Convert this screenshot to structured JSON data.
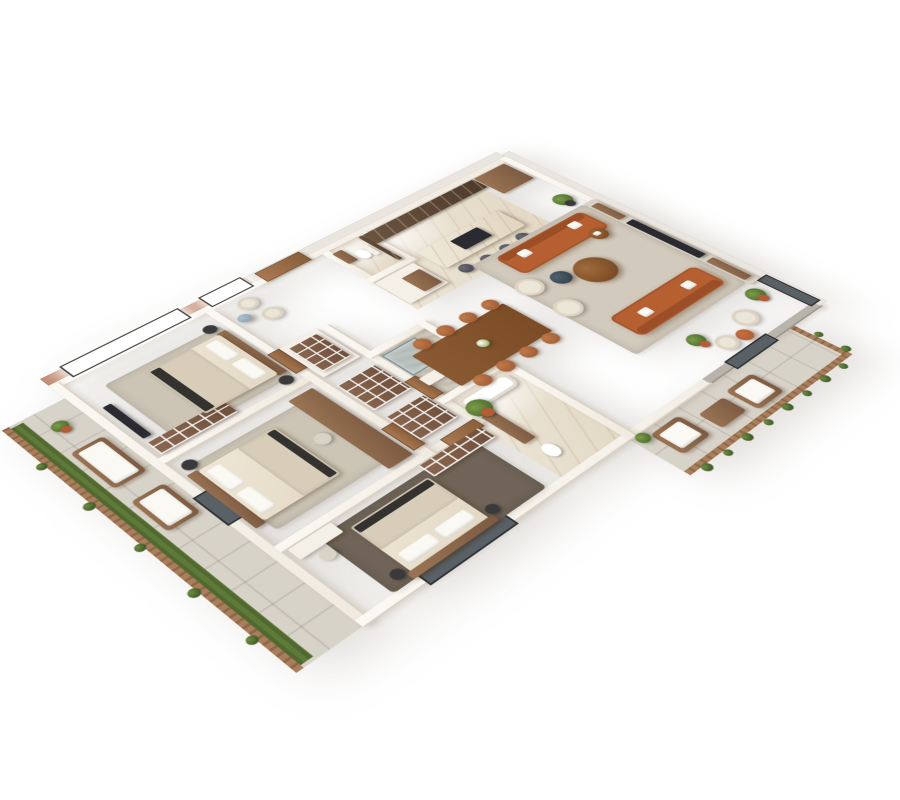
{
  "meta": {
    "kind": "3d-floor-plan-render",
    "projection": "isometric-cutaway",
    "background": "#ffffff",
    "visible_text": "none"
  },
  "palette": {
    "wall": "#f0eadf",
    "wallShadow": "#d9d2c5",
    "exteriorSalmon": "#c28e74",
    "exteriorLight": "#eae6df",
    "concrete": "#b9b4ab",
    "floorWood1": "#97755c",
    "floorWood2": "#85654e",
    "floorMarble1": "#efe8da",
    "floorMarble2": "#e2d8c4",
    "floorTile": "#d8d3c9",
    "floorStone": "#cfc8bb",
    "grass": "#5e7a38",
    "bushGreen": "#3f5c28",
    "fenceWood1": "#a87e5c",
    "fenceWood2": "#8f6848",
    "rugLiving": "#d2cabc",
    "rugBedroom": "#ccc5b6",
    "rugDark": "#6f6457",
    "sofaCognac": "#b65f31",
    "sofaCognacDark": "#9c4e26",
    "chairCognac": "#a5613a",
    "armWhite": "#ece6d8",
    "woodFurn": "#7c5a41",
    "woodFurnLight": "#9a7454",
    "tableWood": "#7c4c26",
    "darkUnit": "#2b2a30",
    "stoolGrey": "#4b4a54",
    "counterDark": "#4e3b2c",
    "mattress": "#e2d8c4",
    "blanket": "#d7cdb9",
    "throwDark": "#34322f",
    "potTerracotta": "#b35c35",
    "plantGreen": "#50702e",
    "marbleBlueTable": "#8fa3b5"
  },
  "scene": {
    "rooms": [
      {
        "id": "balcony-left",
        "name": "side balcony",
        "floor": "tile",
        "furniture": [
          "wood-slat-fence",
          "planter-grass-strip",
          "cushioned-bench",
          "cushioned-bench",
          "potted-plant",
          "shrubs"
        ]
      },
      {
        "id": "bedroom-1",
        "name": "bedroom (top-left)",
        "floor": "herringbone wood",
        "furniture": [
          "double-bed",
          "wood-headboard",
          "pillows",
          "nightstand",
          "nightstand",
          "area-rug",
          "wardrobe-shelves",
          "media-console",
          "window"
        ]
      },
      {
        "id": "bedroom-2",
        "name": "bedroom (middle-left)",
        "floor": "herringbone wood",
        "furniture": [
          "double-bed",
          "slat-headboard-wall",
          "pillows",
          "nightstand",
          "long-desk-console",
          "desk-chair",
          "balcony-door"
        ]
      },
      {
        "id": "master-bedroom",
        "name": "master bedroom (bottom)",
        "floor": "herringbone wood",
        "furniture": [
          "double-bed",
          "dark-area-rug",
          "desk",
          "desk-chair",
          "wardrobe-shelves",
          "nightstand",
          "window"
        ]
      },
      {
        "id": "hallway",
        "name": "hallway / corridor",
        "floor": "herringbone wood",
        "furniture": [
          "lounge-chair",
          "lounge-chair",
          "round-marble-side-table",
          "storage-shelving",
          "storage-shelving",
          "storage-shelving"
        ]
      },
      {
        "id": "entry",
        "name": "entry",
        "floor": "herringbone wood",
        "furniture": [
          "entry-door"
        ]
      },
      {
        "id": "guest-wc",
        "name": "guest WC",
        "floor": "marble",
        "furniture": [
          "toilet",
          "vanity",
          "dark-marble-wall"
        ]
      },
      {
        "id": "shower-bath",
        "name": "shower bathroom",
        "floor": "stone",
        "furniture": [
          "glass-shower",
          "vanity"
        ]
      },
      {
        "id": "master-bath",
        "name": "master bathroom",
        "floor": "marble",
        "furniture": [
          "bathtub",
          "vanity",
          "toilet"
        ]
      },
      {
        "id": "kitchen",
        "name": "kitchen",
        "floor": "marble",
        "furniture": [
          "dark-marble-counter-run",
          "kitchen-island-with-cooktop",
          "bar-stool",
          "bar-stool",
          "bar-stool",
          "bar-stool",
          "white-prep-table",
          "tall-wood-cabinet"
        ]
      },
      {
        "id": "dining",
        "name": "dining area",
        "floor": "herringbone wood",
        "furniture": [
          "rect-dining-table",
          "dining-chair-x8",
          "flower-centerpiece",
          "potted-palm"
        ]
      },
      {
        "id": "living",
        "name": "living room",
        "floor": "herringbone wood",
        "furniture": [
          "area-rug",
          "cognac-leather-sofa",
          "cognac-leather-sofa",
          "round-coffee-table",
          "small-dark-coffee-table",
          "round-side-table",
          "white-armchair",
          "white-armchair",
          "tv-media-wall",
          "potted-plant",
          "potted-plant",
          "reading-nook-armchair",
          "orange-side-table",
          "concrete-half-wall"
        ]
      },
      {
        "id": "terrace",
        "name": "bottom terrace",
        "floor": "tile",
        "furniture": [
          "outdoor-lounge-chair",
          "outdoor-lounge-chair",
          "outdoor-coffee-table",
          "wood-slat-fence",
          "shrubs",
          "glass-door"
        ]
      }
    ]
  }
}
